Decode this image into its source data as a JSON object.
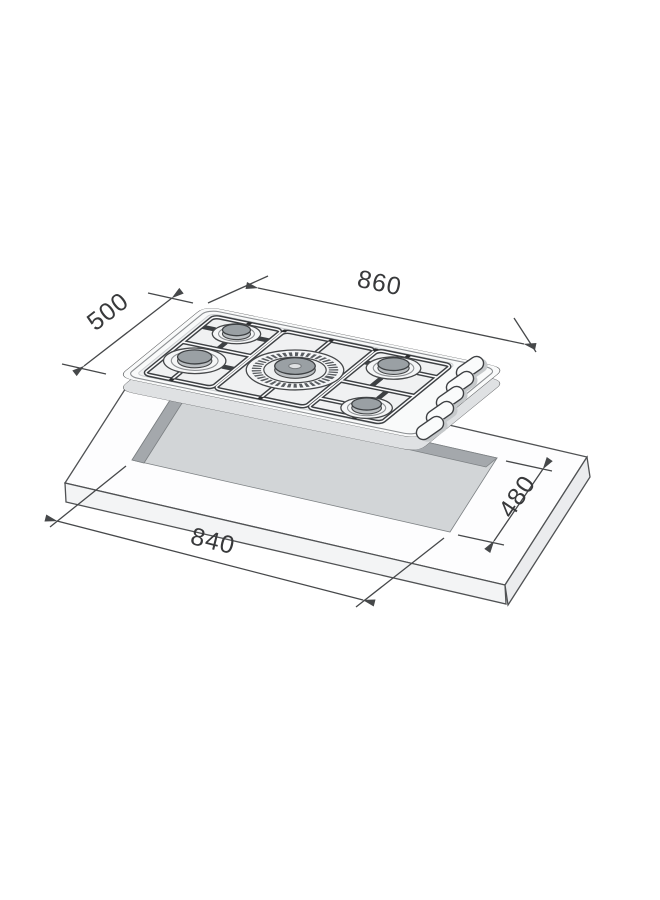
{
  "dimension_labels": {
    "hob_width": "860",
    "hob_depth": "500",
    "cutout_width": "840",
    "cutout_depth": "480"
  },
  "drawing": {
    "burner_count": 5,
    "control_knob_count": 5,
    "shows_worktop_cutout": true
  },
  "colors": {
    "line": "#46484a",
    "hob_surface": "#f9fafa",
    "cutout_fill": "#d2d5d7",
    "cutout_wall": "#a4a8ac",
    "burner_cap": "#9aa0a4",
    "background": "#ffffff"
  }
}
